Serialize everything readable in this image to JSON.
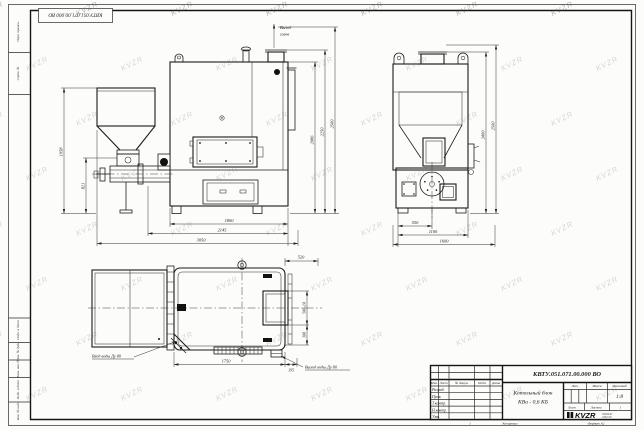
{
  "sheet": {
    "corner_stamp": "КВТУ.051.071.00.000 ВО",
    "watermark_text": "KVZR",
    "margin": {
      "top1": "Перв. примен.",
      "top2": "Справ. №",
      "b1": "Инв. № подл.",
      "b2": "Подп. и дата",
      "b3": "Взам. инв. №",
      "b4": "Инв. № дубл.",
      "b5": "Подп. и дата"
    },
    "footer": {
      "page": "1",
      "copied": "Копировал",
      "format": "Формат А2"
    }
  },
  "front_view": {
    "flue_label_1": "Выход",
    "flue_label_2": "газов",
    "dim_hopper_height": "1958",
    "dim_feeder_height": "821",
    "dim_body_height": "2086",
    "dim_chimney_height": "2250",
    "dim_total_height": "2500",
    "dim_body_width": "1800",
    "dim_mid_width": "2145",
    "dim_total_width": "3050"
  },
  "side_view": {
    "dim_half_width": "550",
    "dim_body_width": "1100",
    "dim_total_width": "1600",
    "dim_height_inner": "2400",
    "dim_height_total": "2500"
  },
  "plan_view": {
    "inlet_label": "Вход воды Ду 80",
    "outlet_label": "Выход воды Ду 80",
    "dim_top": "520",
    "dim_door": "500±10",
    "dim_outlet": "300",
    "dim_length": "1750",
    "dim_offset": "195"
  },
  "title_block": {
    "doc_number": "КВТУ.051.071.00.000 ВО",
    "product_name_line1": "Котельный блок",
    "product_name_line2": "КВа - 0,6 КБ",
    "col_headers": [
      "Изм.",
      "Лист",
      "№ докум.",
      "Подп.",
      "Дата"
    ],
    "row_labels": [
      "Разраб.",
      "Пров.",
      "Т.контр.",
      "Н.контр.",
      "Утв."
    ],
    "lit_label": "Лит.",
    "mass_label": "Масса",
    "scale_label": "Масштаб",
    "scale_value": "1:8",
    "sheet_label": "Лист",
    "sheets_label": "Листов",
    "sheets_value": "1",
    "logo": "KVZR",
    "logo_note1": "453844Р",
    "logo_note2": "3452 КР"
  }
}
